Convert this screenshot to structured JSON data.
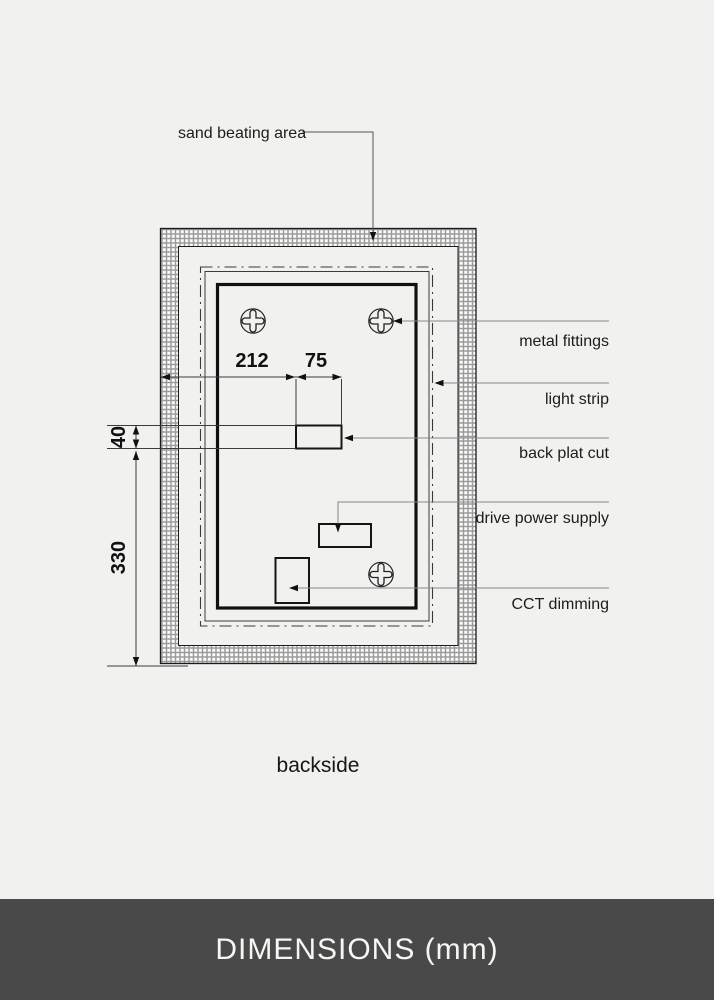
{
  "drawing": {
    "caption": "backside",
    "labels": {
      "sand_beating_area": "sand beating area",
      "metal_fittings": "metal fittings",
      "light_strip": "light strip",
      "back_plat_cut": "back plat cut",
      "drive_power_supply": "drive power supply",
      "cct_dimming": "CCT dimming"
    },
    "dimensions": {
      "d212": "212",
      "d75": "75",
      "d40": "40",
      "d330": "330"
    },
    "icons": {
      "fitting": "screw-head-icon"
    },
    "colors": {
      "line": "#1a1a1a",
      "leader": "#888888",
      "hatch": "#9a9a9a"
    }
  },
  "footer": {
    "title": "DIMENSIONS (mm)",
    "background": "#494949",
    "text_color": "#f6f6f2"
  }
}
